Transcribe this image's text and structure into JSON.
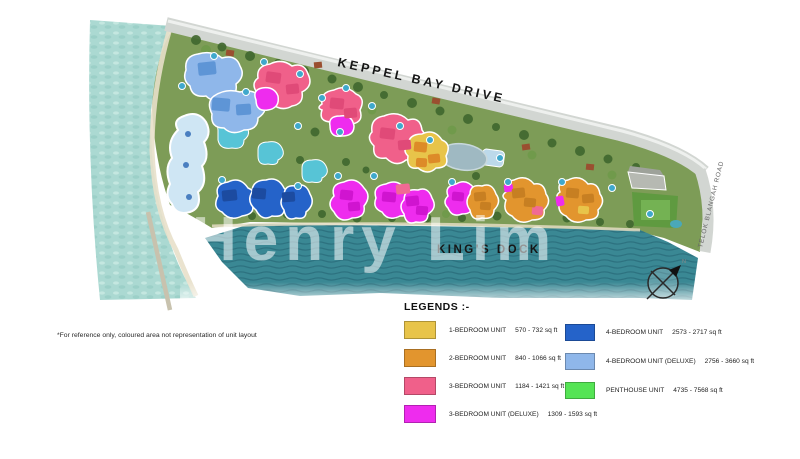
{
  "watermark": "Henry Lim",
  "note": "*For reference only, coloured area not representation of unit layout",
  "site_plan": {
    "roads": {
      "top": "KEPPEL BAY DRIVE",
      "right": "TELOK BLANGAH ROAD"
    },
    "water": {
      "dock_label": "KING'S DOCK"
    },
    "compass": {
      "icon": "north-arrow-compass",
      "label": "N"
    }
  },
  "legend": {
    "title": "LEGENDS :-",
    "items": [
      {
        "label": "1-BEDROOM UNIT",
        "range": "570 - 732 sq ft",
        "color": "#e8c44a"
      },
      {
        "label": "2-BEDROOM UNIT",
        "range": "840 - 1066 sq ft",
        "color": "#e2952e"
      },
      {
        "label": "3-BEDROOM UNIT",
        "range": "1184 - 1421 sq ft",
        "color": "#f0608a"
      },
      {
        "label": "3-BEDROOM UNIT (DELUXE)",
        "range": "1309 - 1593 sq ft",
        "color": "#ee2cee"
      },
      {
        "label": "4-BEDROOM UNIT",
        "range": "2573 - 2717 sq ft",
        "color": "#2563c9"
      },
      {
        "label": "4-BEDROOM UNIT (DELUXE)",
        "range": "2756 - 3660 sq ft",
        "color": "#8fb7ea"
      },
      {
        "label": "PENTHOUSE UNIT",
        "range": "4735 - 7568 sq ft",
        "color": "#55e455"
      }
    ]
  },
  "colors": {
    "open_water": "#abd9d2",
    "dock_water": "#3a8894",
    "land": "#7d9c57",
    "road": "#d2d6d2"
  }
}
